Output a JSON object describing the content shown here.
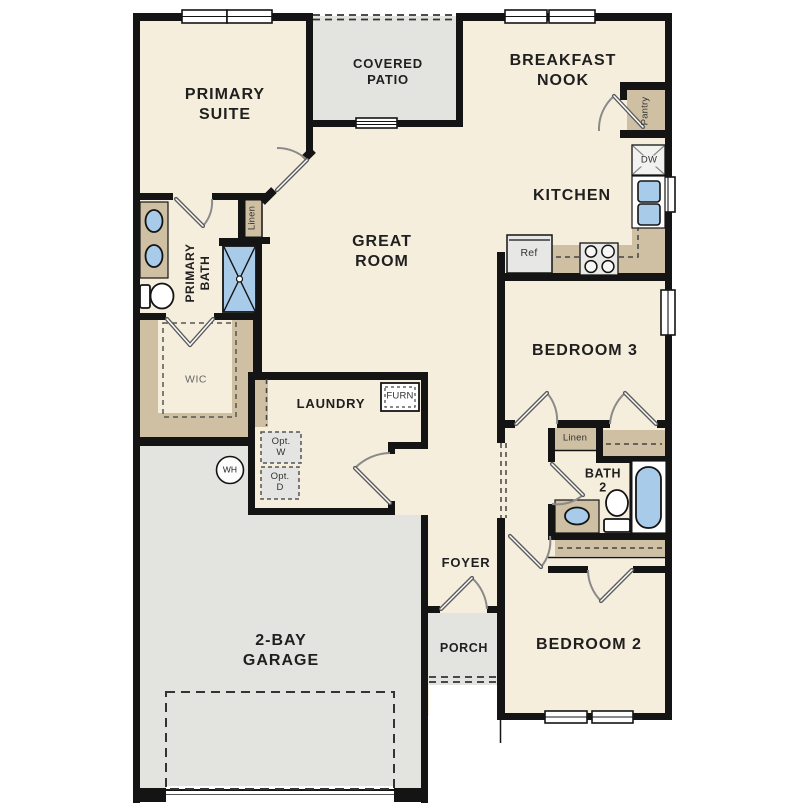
{
  "rooms": {
    "primary_suite": "PRIMARY\nSUITE",
    "covered_patio": "COVERED\nPATIO",
    "breakfast_nook": "BREAKFAST\nNOOK",
    "kitchen": "KITCHEN",
    "great_room": "GREAT\nROOM",
    "bedroom3": "BEDROOM 3",
    "bedroom2": "BEDROOM 2",
    "bath2": "BATH\n2",
    "primary_bath": "PRIMARY\nBATH",
    "wic": "WIC",
    "laundry": "LAUNDRY",
    "foyer": "FOYER",
    "porch": "PORCH",
    "garage": "2-BAY\nGARAGE"
  },
  "fixtures": {
    "pantry": "Pantry",
    "linen_primary": "Linen",
    "linen_hall": "Linen",
    "dishwasher": "DW",
    "refrigerator": "Ref",
    "furnace": "FURN",
    "opt_washer": "Opt.\nW",
    "opt_dryer": "Opt.\nD",
    "water_heater": "WH"
  },
  "colors": {
    "floor": "#f6eedd",
    "hard": "#e3e3e0",
    "casework": "#cfc0a4",
    "fixture_blue": "#a9cbea",
    "wall": "#141414"
  }
}
